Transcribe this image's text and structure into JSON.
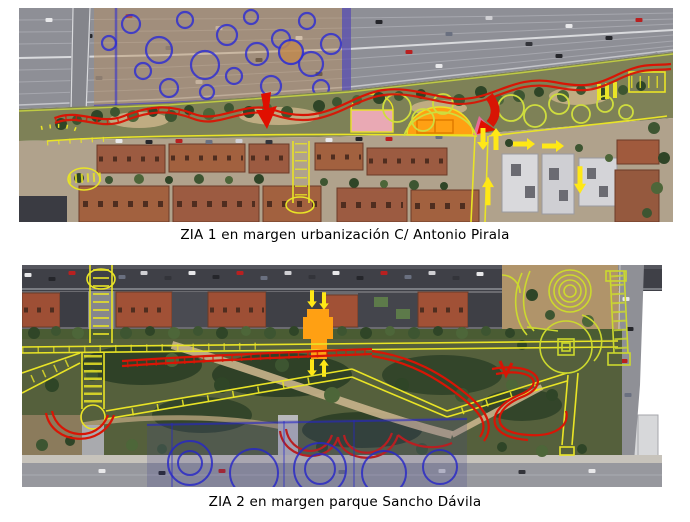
{
  "page": {
    "background": "#ffffff"
  },
  "figures": [
    {
      "id": "zia1",
      "caption": "ZIA 1 en margen urbanización C/ Antonio Pirala",
      "kind": "annotated aerial photograph",
      "annotations": {
        "planned_paths_yellow": "#e9e426",
        "tree_outline_yellow_green": "#cfdd3e",
        "vegetation_plan_blue": "#2b2bd5",
        "route_marking_red": "#d81505",
        "highlight_area_orange": "#ffa013",
        "court_pink": "#f06aa0",
        "direction_arrow_yellow": "#ffe816"
      }
    },
    {
      "id": "zia2",
      "caption": "ZIA 2 en margen parque Sancho Dávila",
      "kind": "annotated aerial photograph",
      "annotations": {
        "planned_paths_yellow": "#e9e426",
        "vegetation_plan_blue": "#2b2bd5",
        "route_marking_red": "#d81505",
        "highlight_area_orange": "#ffa013",
        "direction_arrow_yellow": "#ffe816"
      }
    }
  ],
  "icons": {
    "direction-arrow": "triangle-arrow-shape"
  }
}
